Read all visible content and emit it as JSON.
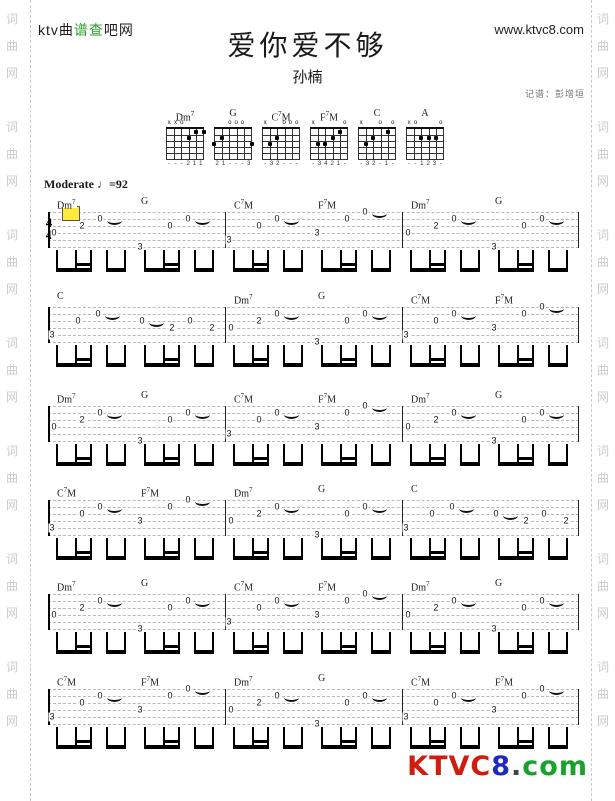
{
  "header": {
    "logo_parts": [
      {
        "text": "ktv曲",
        "color": "#1c1c1c"
      },
      {
        "text": "谱查",
        "color": "#2e9e2e"
      },
      {
        "text": "吧网",
        "color": "#1c1c1c"
      }
    ],
    "url": "www.ktvc8.com",
    "title": "爱你爱不够",
    "artist": "孙楠",
    "credit": "记谱：彭增垣"
  },
  "watermark": {
    "chars": [
      "词",
      "曲",
      "网"
    ],
    "groups": 7,
    "color": "#cbcbcb"
  },
  "chord_diagrams": [
    {
      "pre": "Dm",
      "sup": "7",
      "post": "",
      "markers": [
        "x",
        "x",
        "o",
        "",
        "",
        ""
      ],
      "dots": [
        [
          3,
          2
        ],
        [
          4,
          1
        ],
        [
          5,
          1
        ]
      ],
      "fingers": [
        "-",
        "-",
        "-",
        "2",
        "1",
        "1"
      ]
    },
    {
      "pre": "G",
      "sup": "",
      "post": "",
      "markers": [
        "",
        "",
        "o",
        "o",
        "o",
        ""
      ],
      "dots": [
        [
          0,
          3
        ],
        [
          1,
          2
        ],
        [
          5,
          3
        ]
      ],
      "fingers": [
        "2",
        "1",
        "-",
        "-",
        "-",
        "3"
      ]
    },
    {
      "pre": "C",
      "sup": "7",
      "post": "M",
      "markers": [
        "x",
        "",
        "",
        "o",
        "o",
        "o"
      ],
      "dots": [
        [
          1,
          3
        ],
        [
          2,
          2
        ]
      ],
      "fingers": [
        "-",
        "3",
        "2",
        "-",
        "-",
        "-"
      ]
    },
    {
      "pre": "F",
      "sup": "7",
      "post": "M",
      "markers": [
        "x",
        "",
        "",
        "",
        "",
        "o"
      ],
      "dots": [
        [
          1,
          3
        ],
        [
          2,
          3
        ],
        [
          3,
          2
        ],
        [
          4,
          1
        ]
      ],
      "fingers": [
        "-",
        "3",
        "4",
        "2",
        "1",
        "-"
      ]
    },
    {
      "pre": "C",
      "sup": "",
      "post": "",
      "markers": [
        "x",
        "",
        "",
        "o",
        "",
        "o"
      ],
      "dots": [
        [
          1,
          3
        ],
        [
          2,
          2
        ],
        [
          4,
          1
        ]
      ],
      "fingers": [
        "-",
        "3",
        "2",
        "-",
        "1",
        "-"
      ]
    },
    {
      "pre": "A",
      "sup": "",
      "post": "",
      "markers": [
        "x",
        "o",
        "",
        "",
        "",
        "o"
      ],
      "dots": [
        [
          2,
          2
        ],
        [
          3,
          2
        ],
        [
          4,
          2
        ]
      ],
      "fingers": [
        "-",
        "-",
        "1",
        "2",
        "3",
        "-"
      ]
    }
  ],
  "score": {
    "tempo_label": "Moderate",
    "tempo_note_glyph": "♩",
    "tempo_eq": "=92",
    "time_signature": [
      "4",
      "4"
    ],
    "chord_labels": {
      "Dm7": {
        "pre": "Dm",
        "sup": "7",
        "post": ""
      },
      "G": {
        "pre": "G",
        "sup": "",
        "post": ""
      },
      "C7M": {
        "pre": "C",
        "sup": "7",
        "post": "M"
      },
      "F7M": {
        "pre": "F",
        "sup": "7",
        "post": "M"
      },
      "C": {
        "pre": "C",
        "sup": "",
        "post": ""
      }
    },
    "cell_patterns": {
      "Dm7": [
        [
          4,
          "0",
          6,
          0
        ],
        [
          3,
          "2",
          34,
          0
        ],
        [
          2,
          "0",
          52,
          1
        ]
      ],
      "G": [
        [
          6,
          "3",
          4,
          0
        ],
        [
          3,
          "0",
          34,
          0
        ],
        [
          2,
          "0",
          52,
          1
        ]
      ],
      "C7M": [
        [
          5,
          "3",
          4,
          0
        ],
        [
          3,
          "0",
          34,
          0
        ],
        [
          2,
          "0",
          52,
          1
        ]
      ],
      "F7M": [
        [
          4,
          "3",
          4,
          0
        ],
        [
          2,
          "0",
          34,
          0
        ],
        [
          1,
          "0",
          52,
          1
        ]
      ],
      "C1": [
        [
          5,
          "3",
          4,
          0
        ],
        [
          3,
          "0",
          30,
          0
        ],
        [
          2,
          "0",
          50,
          1
        ]
      ],
      "C2": [
        [
          3,
          "0",
          6,
          1
        ],
        [
          4,
          "2",
          36,
          0
        ],
        [
          3,
          "0",
          54,
          0
        ],
        [
          4,
          "2",
          76,
          0
        ]
      ]
    },
    "systems": [
      {
        "measures": [
          [
            "Dm7",
            "G"
          ],
          [
            "C7M",
            "F7M"
          ],
          [
            "Dm7",
            "G"
          ]
        ],
        "time_signature": true,
        "highlight_marker": true
      },
      {
        "measures": [
          [
            "C"
          ],
          [
            "Dm7",
            "G"
          ],
          [
            "C7M",
            "F7M"
          ]
        ]
      },
      {
        "measures": [
          [
            "Dm7",
            "G"
          ],
          [
            "C7M",
            "F7M"
          ],
          [
            "Dm7",
            "G"
          ]
        ]
      },
      {
        "measures": [
          [
            "C7M",
            "F7M"
          ],
          [
            "Dm7",
            "G"
          ],
          [
            "C"
          ]
        ]
      },
      {
        "measures": [
          [
            "Dm7",
            "G"
          ],
          [
            "C7M",
            "F7M"
          ],
          [
            "Dm7",
            "G"
          ]
        ]
      },
      {
        "measures": [
          [
            "C7M",
            "F7M"
          ],
          [
            "Dm7",
            "G"
          ],
          [
            "C7M",
            "F7M"
          ]
        ]
      }
    ]
  },
  "footer": {
    "logo_parts": [
      {
        "text": "KTVC",
        "color": "#d01d10"
      },
      {
        "text": "8",
        "color": "#1c2bbd"
      },
      {
        "text": ".",
        "color": "#444444"
      },
      {
        "text": "com",
        "color": "#17a32b"
      }
    ]
  }
}
